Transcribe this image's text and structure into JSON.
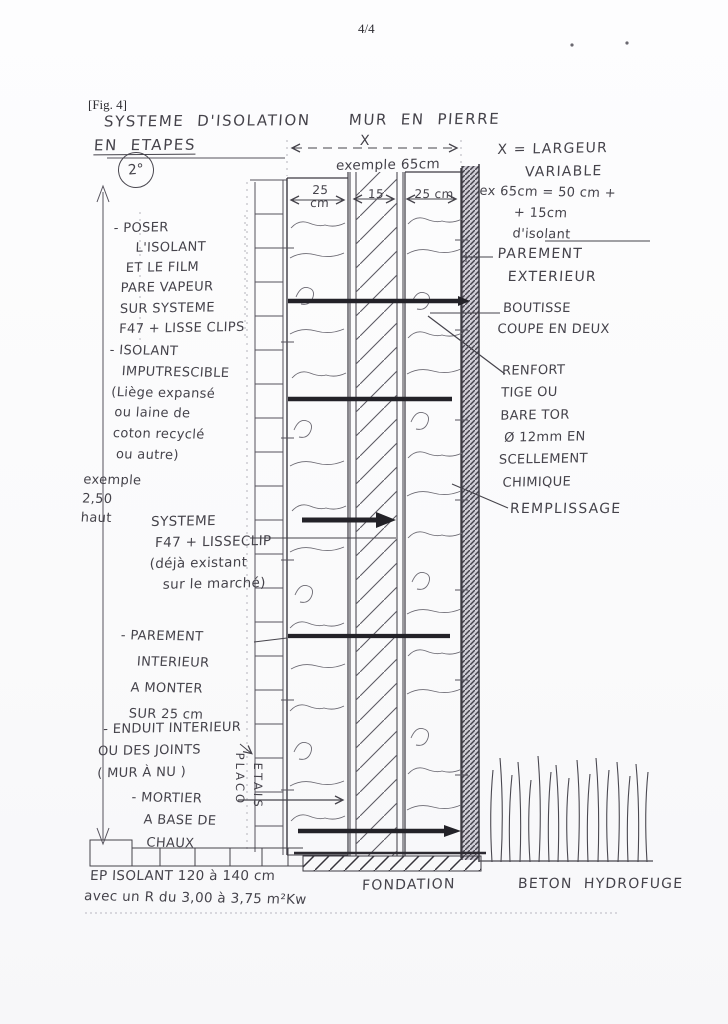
{
  "page": {
    "number": "4/4",
    "figure_label": "[Fig. 4]"
  },
  "title": {
    "main": "SYSTEME  D'ISOLATION      MUR  EN  PIERRE",
    "steps": "EN  ETAPES",
    "step_badge": "2°"
  },
  "dimensions": {
    "overall_label": "X",
    "overall_example": "exemple 65cm",
    "left_wythe": "25\ncm",
    "core": "15",
    "right_wythe": "25 cm",
    "height_note": "exemple\n2,50\nhaut"
  },
  "right_annotations": {
    "largeur": "X = LARGEUR\n     VARIABLE",
    "largeur_example": "ex 65cm = 50 cm +\n        + 15cm\n        d'isolant",
    "parement_exterieur": "PAREMENT\n  EXTERIEUR",
    "boutisse": " BOUTISSE\nCOUPE EN DEUX",
    "renfort": "RENFORT\nTIGE OU\nBARE TOR\n Ø 12mm EN\nSCELLEMENT\n CHIMIQUE",
    "remplissage": "REMPLISSAGE"
  },
  "left_annotations": {
    "poser": "- POSER\n     L'ISOLANT\n   ET LE FILM\n  PARE VAPEUR\n  SUR SYSTEME\n  F47 + LISSE CLIPS",
    "isolant": "- ISOLANT\n   IMPUTRESCIBLE\n (Liège expansé\n  ou laine de\n  coton recyclé\n   ou autre)",
    "systeme": "SYSTEME\n F47 + LISSECLIP\n(déjà existant\n   sur le marché)",
    "parement_interieur": "- PAREMENT\n    INTERIEUR\n   A MONTER\n   SUR 25 cm",
    "enduit": " - ENDUIT INTERIEUR\nOU DES JOINTS\n( MUR À NU )",
    "mortier": "- MORTIER\n   A BASE DE\n    CHAUX"
  },
  "vertical_labels": {
    "placo": "PLACO",
    "etais": "ETAIS"
  },
  "bottom": {
    "fondation": "FONDATION",
    "beton_hydrofuge": "BETON  HYDROFUGE",
    "ep_isolant": "EP ISOLANT 120 à 140 cm",
    "r_value": "avec un R du 3,00 à 3,75 m²Kw"
  }
}
